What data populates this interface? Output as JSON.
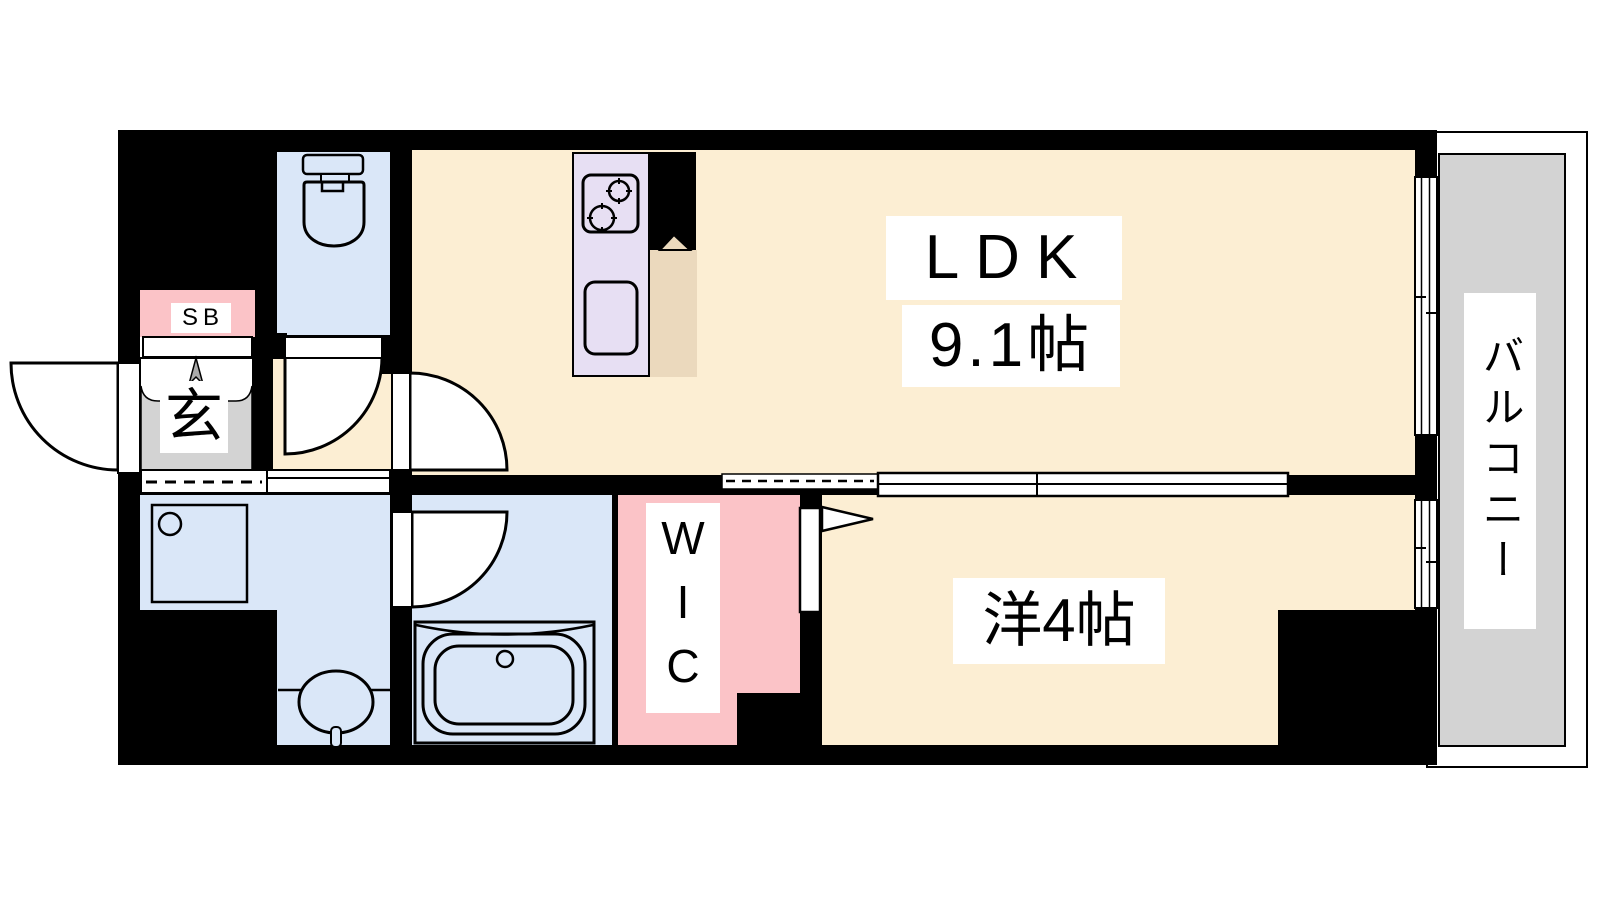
{
  "title": "apartment-floor-plan",
  "colors": {
    "wall": "#000000",
    "cream": "#FCEED3",
    "blue": "#DAE7F8",
    "pink": "#FBC3C7",
    "lavender": "#E7DFF3",
    "gray": "#D3D3D3",
    "tan": "#EBD9BD",
    "paper": "#FFFFFF"
  },
  "rooms": {
    "ldk": {
      "name": "LDK",
      "size": "9.1帖"
    },
    "western": {
      "name": "洋4帖"
    },
    "wic": {
      "name": "WIC"
    },
    "balcony": {
      "name": "バルコニー"
    },
    "entrance": {
      "name": "玄"
    },
    "shoe_box": {
      "name": "SB"
    }
  },
  "fixtures": [
    "toilet",
    "kitchen-stove",
    "kitchen-sink",
    "washing-machine-pan",
    "wash-basin",
    "bathtub",
    "entrance-arrow",
    "sliding-door",
    "window"
  ]
}
